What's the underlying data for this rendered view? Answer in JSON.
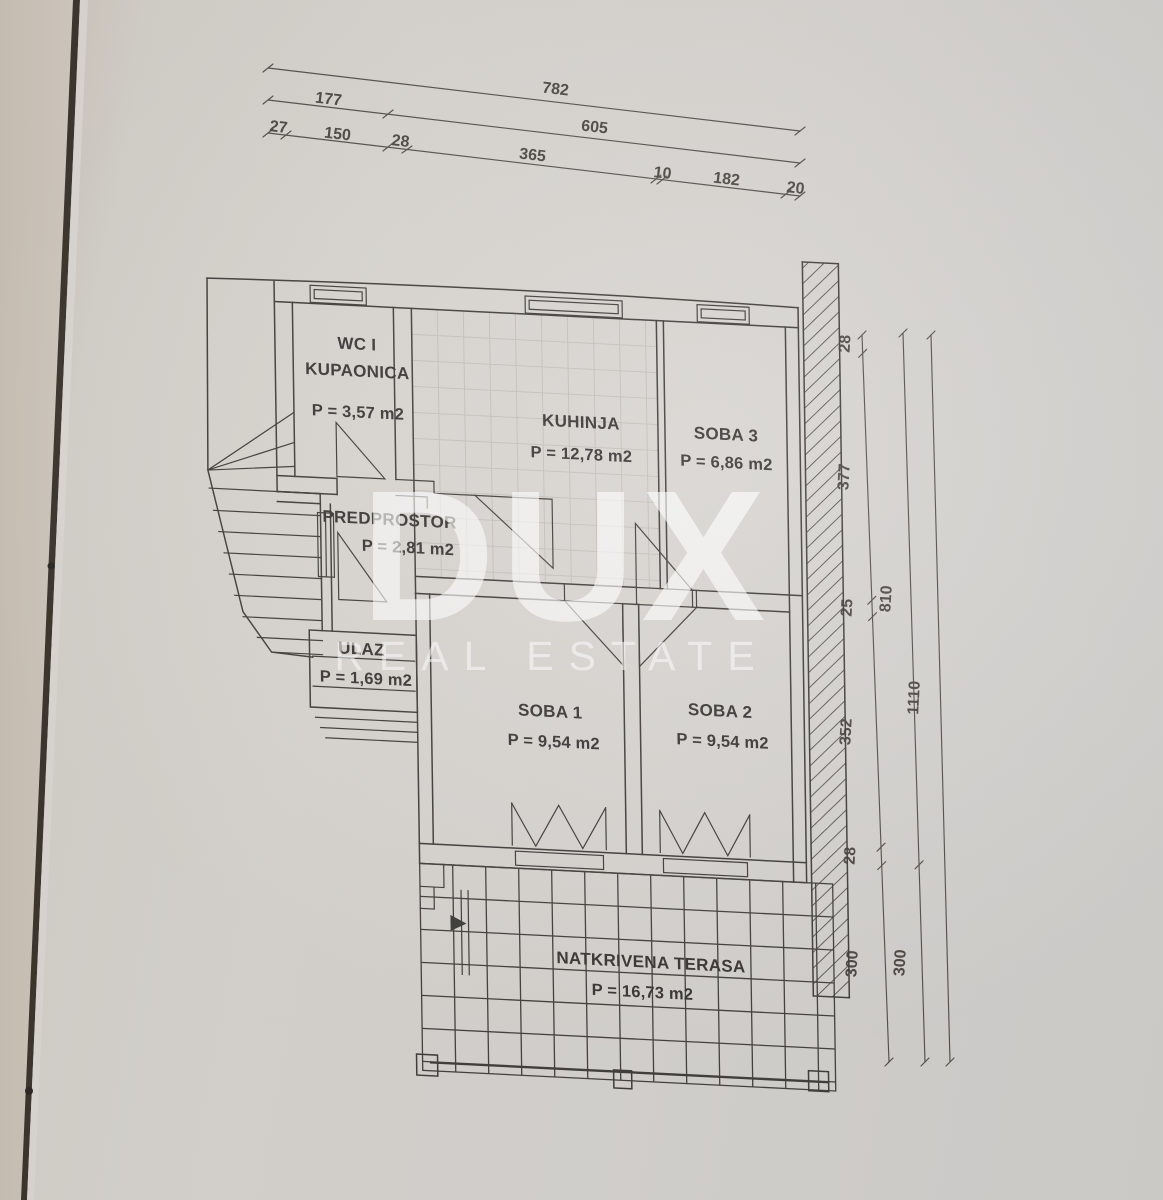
{
  "document": {
    "type": "floor-plan-photo",
    "language": "hr"
  },
  "watermark": {
    "brand": "DUX",
    "tagline": "REAL ESTATE"
  },
  "rooms": {
    "wc_kupaonica": {
      "name_line1": "WC I",
      "name_line2": "KUPAONICA",
      "area": "P = 3,57 m2"
    },
    "kuhinja": {
      "name": "KUHINJA",
      "area": "P = 12,78 m2"
    },
    "soba3": {
      "name": "SOBA 3",
      "area": "P = 6,86 m2"
    },
    "predprostor": {
      "name": "PREDPROSTOR",
      "area": "P = 2,81 m2"
    },
    "ulaz": {
      "name": "ULAZ",
      "area": "P = 1,69 m2"
    },
    "soba1": {
      "name": "SOBA 1",
      "area": "P = 9,54 m2"
    },
    "soba2": {
      "name": "SOBA 2",
      "area": "P = 9,54 m2"
    },
    "natkrivena_terasa": {
      "name": "NATKRIVENA TERASA",
      "area": "P = 16,73 m2"
    }
  },
  "dimensions": {
    "top_row1": {
      "total": "782"
    },
    "top_row2": {
      "segments": [
        "177",
        "605"
      ]
    },
    "top_row3": {
      "segments": [
        "27",
        "150",
        "28",
        "365",
        "10",
        "182",
        "20"
      ]
    },
    "right_col_inner": {
      "segments": [
        "28",
        "377",
        "25",
        "352",
        "28",
        "300"
      ]
    },
    "right_col_middle": {
      "segments": [
        "810",
        "300"
      ]
    },
    "right_col_outer": {
      "segments": [
        "1110"
      ]
    }
  },
  "colors": {
    "paper": "#d8d5d0",
    "ink": "#42403c",
    "dim_ink": "#4e4b46",
    "watermark": "#ffffff",
    "spine": "#3e372f"
  }
}
